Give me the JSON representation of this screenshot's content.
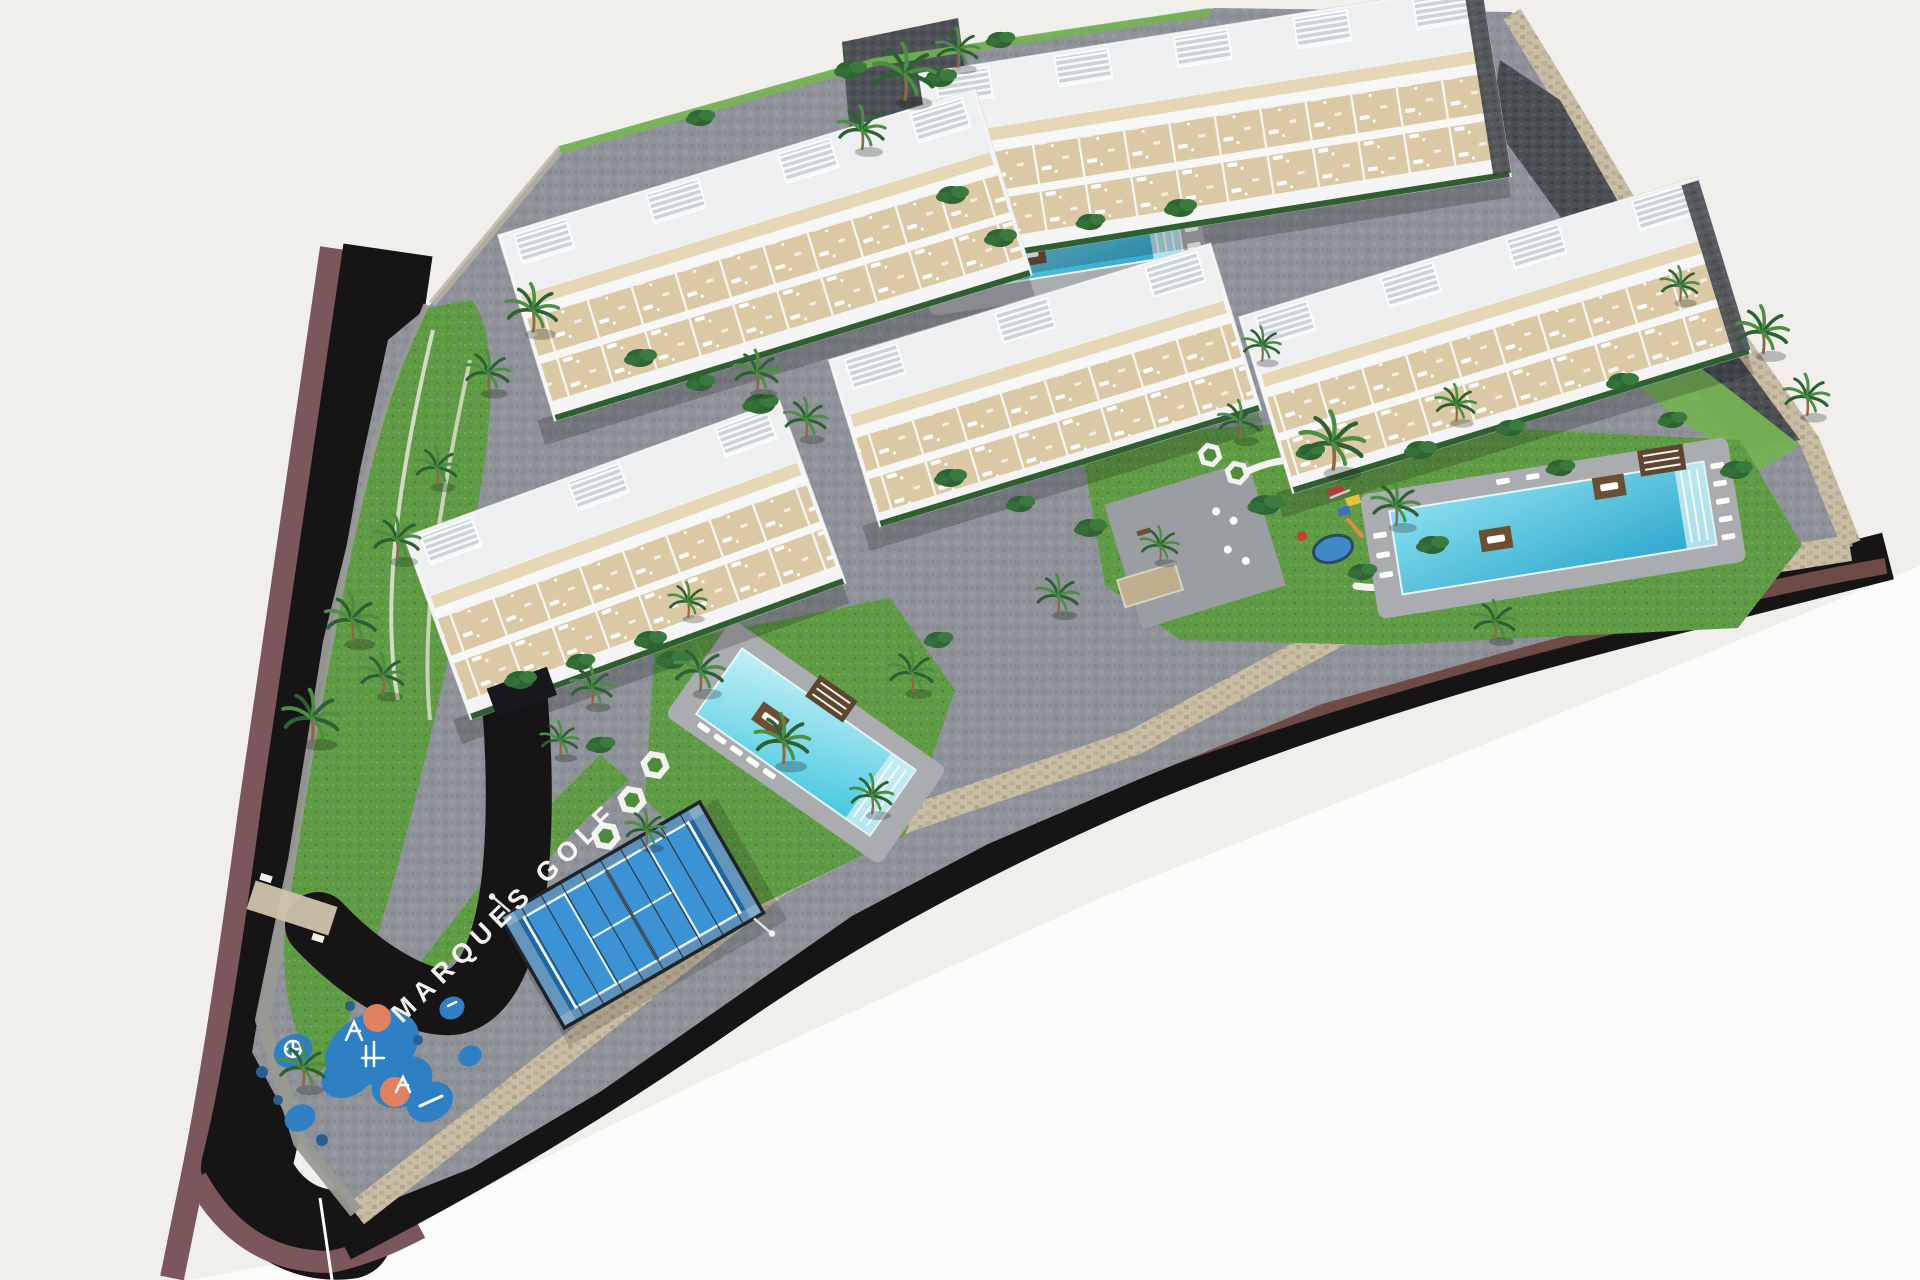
{
  "signage": {
    "site_label": "MARQUES GOLF"
  },
  "palette": {
    "bg": "#f0efec",
    "bgBright": "#fbfbf9",
    "asphalt": "#171415",
    "sidewalk": "#7b565a",
    "sidewalkInner": "#6f4b47",
    "paver": "#8f9298",
    "cobbleDark": "#4e5257",
    "grass": "#5f9a44",
    "grassL": "#74b254",
    "hedge": "#2f5f31",
    "palmDark": "#2d6134",
    "palmLight": "#4c8f43",
    "trunk": "#8a6a46",
    "bld": "#f4f5f4",
    "terrace": "#dbc9a5",
    "deck": "#abacb0",
    "stoneWall": "#c9bda5",
    "stoneGray": "#9a9a94",
    "darkStone": "#45484d",
    "pool1": "#2ba6cd",
    "pool1l": "#8adfee",
    "pool2": "#3ec5e0",
    "pool2l": "#c2f0f4",
    "padel": "#1e66a6",
    "padelLight": "#3c93d4",
    "cage": "#20242a",
    "playBlue": "#2f7fc4",
    "playOrange": "#e08262",
    "sign": "#fafaf6"
  },
  "buildings": [
    {
      "id": "building-top",
      "cx": 1215,
      "cy": 125,
      "len": 570,
      "wid": 195,
      "rot": -9,
      "pergolas": 5,
      "stone_end": true,
      "garage": false
    },
    {
      "id": "building-upper-left",
      "cx": 765,
      "cy": 255,
      "len": 500,
      "wid": 195,
      "rot": -17,
      "pergolas": 4,
      "stone_end": false,
      "garage": false
    },
    {
      "id": "building-right",
      "cx": 1495,
      "cy": 335,
      "len": 480,
      "wid": 185,
      "rot": -17,
      "pergolas": 4,
      "stone_end": true,
      "garage": false
    },
    {
      "id": "building-center",
      "cx": 1045,
      "cy": 385,
      "len": 400,
      "wid": 175,
      "rot": -17,
      "pergolas": 3,
      "stone_end": false,
      "garage": false
    },
    {
      "id": "building-lower-left",
      "cx": 625,
      "cy": 560,
      "len": 400,
      "wid": 195,
      "rot": -20,
      "pergolas": 3,
      "stone_end": false,
      "garage": true
    }
  ],
  "pools": [
    {
      "id": "pool-north",
      "cx": 1062,
      "cy": 243,
      "rot": -9,
      "pool_len": 236,
      "pool_wid": 62,
      "deck_len": 282,
      "deck_wid": 104,
      "water": "grad1",
      "platforms": [
        [
          -34,
          6
        ],
        [
          52,
          -24
        ]
      ],
      "loungers": [
        [
          130,
          -28
        ],
        [
          130,
          -11
        ],
        [
          130,
          6
        ],
        [
          130,
          23
        ],
        [
          -130,
          -6
        ],
        [
          -130,
          11
        ],
        [
          -130,
          28
        ]
      ],
      "cabana": null
    },
    {
      "id": "pool-east",
      "cx": 1553,
      "cy": 528,
      "rot": -9,
      "pool_len": 318,
      "pool_wid": 84,
      "deck_len": 372,
      "deck_wid": 126,
      "water": "grad1",
      "platforms": [
        [
          -58,
          2
        ],
        [
          62,
          -32
        ]
      ],
      "loungers": [
        [
          172,
          -36
        ],
        [
          172,
          -18
        ],
        [
          172,
          0
        ],
        [
          172,
          18
        ],
        [
          172,
          36
        ],
        [
          -172,
          -20
        ],
        [
          -172,
          0
        ],
        [
          -172,
          20
        ],
        [
          -42,
          -54
        ],
        [
          -12,
          -54
        ],
        [
          18,
          -54
        ]
      ],
      "cabana": [
        118,
        -50
      ]
    },
    {
      "id": "pool-central",
      "cx": 806,
      "cy": 742,
      "rot": 35,
      "pool_len": 212,
      "pool_wid": 80,
      "deck_len": 262,
      "deck_wid": 118,
      "water": "grad2",
      "platforms": [
        [
          -42,
          2
        ]
      ],
      "loungers": [
        [
          -92,
          47
        ],
        [
          -72,
          47
        ],
        [
          -52,
          47
        ],
        [
          -32,
          47
        ],
        [
          -12,
          47
        ]
      ],
      "cabana": [
        -4,
        -50
      ]
    }
  ],
  "vegetation": {
    "palms": [
      [
        905,
        98,
        1.3
      ],
      [
        958,
        66,
        0.9
      ],
      [
        862,
        148,
        1.0
      ],
      [
        533,
        330,
        1.1
      ],
      [
        488,
        390,
        0.95
      ],
      [
        437,
        484,
        0.9
      ],
      [
        397,
        558,
        1.0
      ],
      [
        352,
        640,
        1.1
      ],
      [
        312,
        740,
        1.2
      ],
      [
        303,
        1086,
        1.0
      ],
      [
        383,
        693,
        0.95
      ],
      [
        592,
        704,
        0.9
      ],
      [
        646,
        845,
        0.85
      ],
      [
        700,
        690,
        1.05
      ],
      [
        783,
        762,
        1.15
      ],
      [
        912,
        690,
        0.95
      ],
      [
        688,
        616,
        0.8
      ],
      [
        757,
        390,
        0.95
      ],
      [
        806,
        436,
        0.9
      ],
      [
        1058,
        612,
        0.9
      ],
      [
        1160,
        560,
        0.8
      ],
      [
        1240,
        438,
        0.9
      ],
      [
        1333,
        468,
        1.35
      ],
      [
        1396,
        524,
        1.0
      ],
      [
        1456,
        420,
        0.85
      ],
      [
        1262,
        360,
        0.8
      ],
      [
        1763,
        352,
        1.1
      ],
      [
        1807,
        414,
        0.95
      ],
      [
        1680,
        300,
        0.8
      ],
      [
        1495,
        638,
        0.9
      ],
      [
        560,
        755,
        0.8
      ],
      [
        872,
        812,
        0.9
      ]
    ],
    "bushes": [
      [
        640,
        358,
        1
      ],
      [
        700,
        383,
        0.9
      ],
      [
        760,
        404,
        1.1
      ],
      [
        950,
        478,
        1
      ],
      [
        1020,
        504,
        0.9
      ],
      [
        1090,
        528,
        1
      ],
      [
        1310,
        452,
        0.9
      ],
      [
        1420,
        450,
        1
      ],
      [
        1510,
        428,
        0.9
      ],
      [
        1000,
        238,
        1
      ],
      [
        1090,
        222,
        0.9
      ],
      [
        1180,
        208,
        1
      ],
      [
        520,
        680,
        1
      ],
      [
        580,
        662,
        0.9
      ],
      [
        650,
        640,
        1
      ],
      [
        1265,
        505,
        1.1
      ],
      [
        1362,
        572,
        0.9
      ],
      [
        1432,
        545,
        1
      ],
      [
        1560,
        468,
        0.9
      ],
      [
        1622,
        382,
        1
      ],
      [
        1672,
        420,
        0.9
      ],
      [
        940,
        78,
        1
      ],
      [
        600,
        745,
        0.9
      ],
      [
        672,
        660,
        1
      ],
      [
        938,
        640,
        0.9
      ],
      [
        952,
        195,
        1
      ],
      [
        700,
        118,
        0.9
      ],
      [
        850,
        70,
        1
      ],
      [
        1000,
        40,
        0.9
      ],
      [
        1736,
        470,
        1
      ]
    ]
  },
  "playground": {
    "rotation": -28,
    "blue_pads": [
      [
        372,
        1048,
        50,
        34
      ],
      [
        402,
        1082,
        32,
        24
      ],
      [
        348,
        1076,
        28,
        20
      ],
      [
        293,
        1051,
        20,
        16
      ],
      [
        300,
        1118,
        16,
        13
      ],
      [
        430,
        1102,
        24,
        19
      ],
      [
        452,
        1008,
        13,
        11
      ],
      [
        470,
        1056,
        12,
        10
      ]
    ],
    "orange_circles": [
      [
        377,
        1018,
        14
      ],
      [
        395,
        1092,
        15
      ]
    ],
    "navy_dots": [
      [
        262,
        1072,
        6
      ],
      [
        278,
        1100,
        5
      ],
      [
        322,
        1140,
        6
      ],
      [
        350,
        1006,
        5
      ],
      [
        418,
        1040,
        5
      ]
    ]
  }
}
